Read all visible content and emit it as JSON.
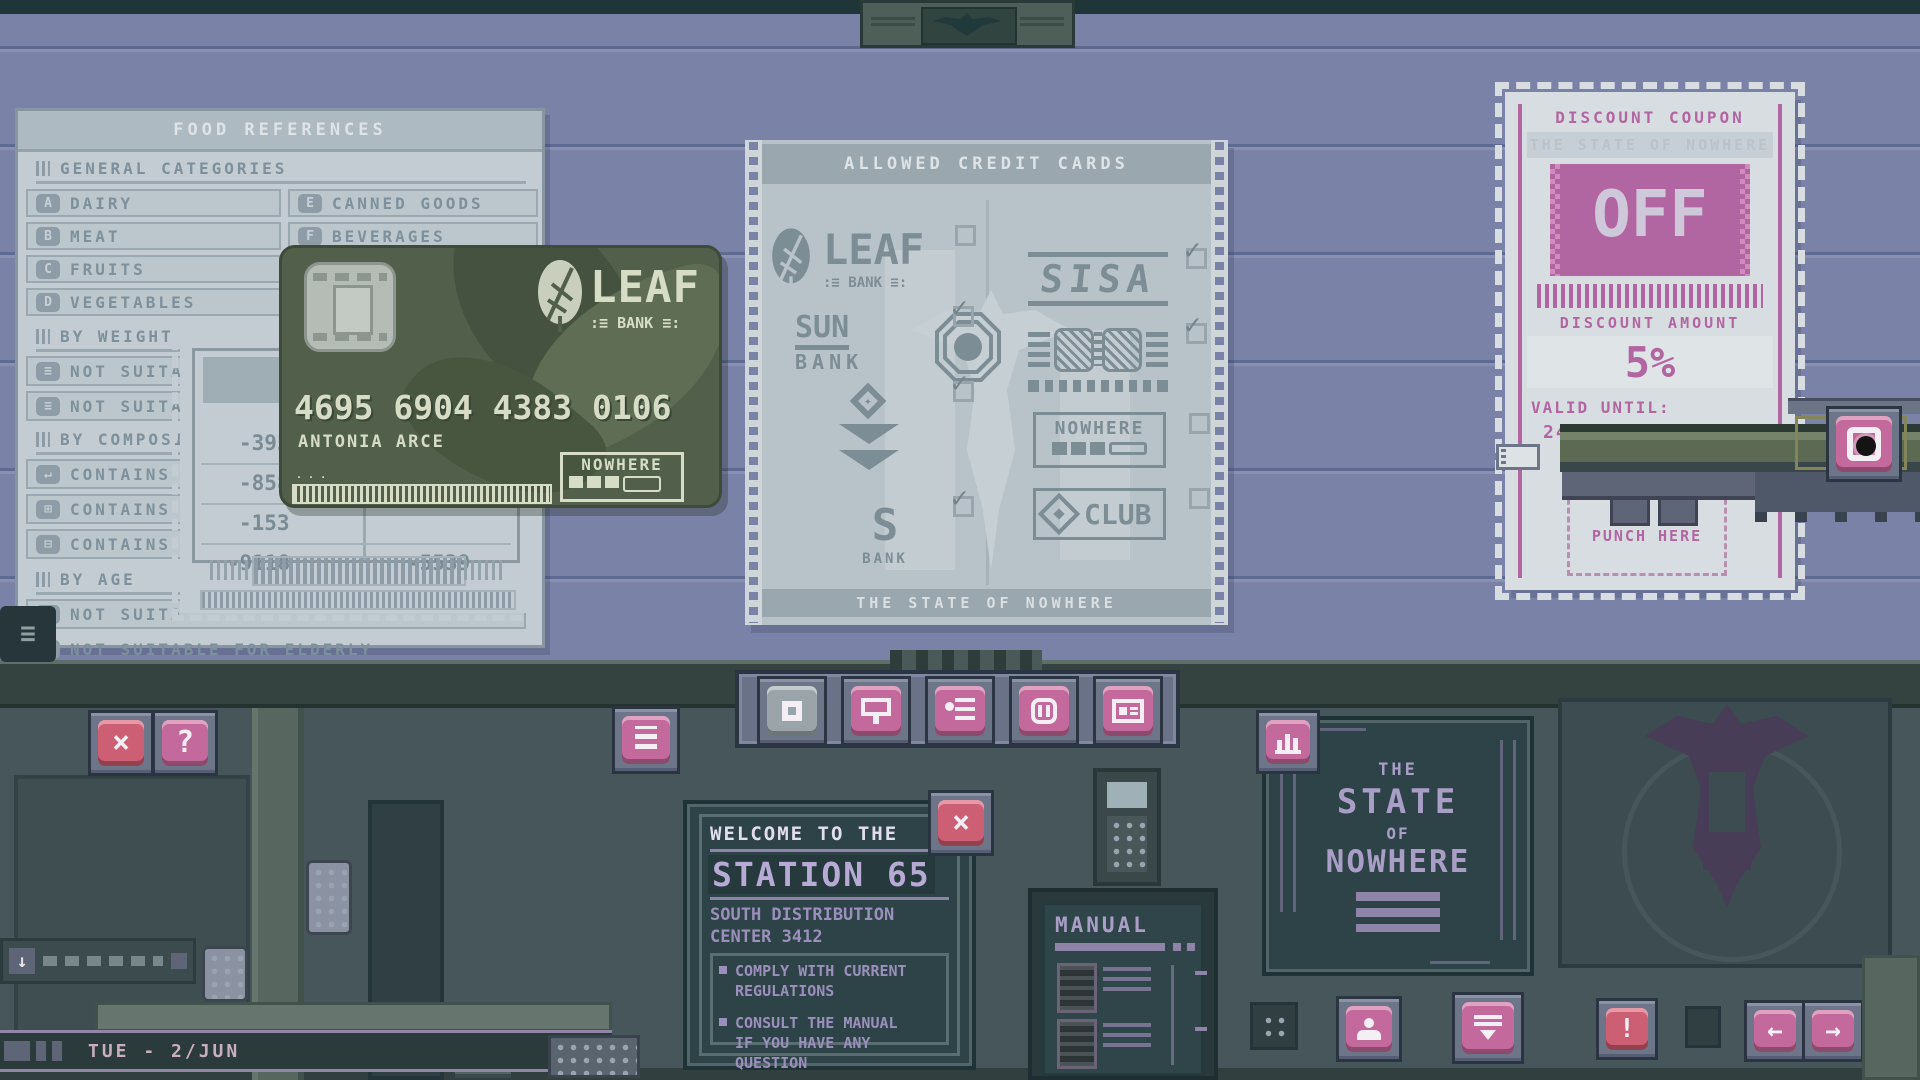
{
  "colors": {
    "wall": "#7a83a7",
    "console": "#47565a",
    "paper": "#c2ccd2",
    "poster_paper": "#b8c3c9",
    "card_green": "#515f4b",
    "coupon_pink": "#b266a1",
    "button_pink": "#c4699b",
    "button_red": "#cd5f74",
    "board_teal": "#2e4347",
    "text_lavender": "#a99fc6"
  },
  "food_references": {
    "title": "FOOD REFERENCES",
    "general": {
      "header": "GENERAL CATEGORIES",
      "left": [
        {
          "key": "A",
          "label": "DAIRY"
        },
        {
          "key": "B",
          "label": "MEAT"
        },
        {
          "key": "C",
          "label": "FRUITS"
        },
        {
          "key": "D",
          "label": "VEGETABLES"
        }
      ],
      "right": [
        {
          "key": "E",
          "label": "CANNED GOODS"
        },
        {
          "key": "F",
          "label": "BEVERAGES"
        }
      ]
    },
    "by_weight": {
      "header": "BY WEIGHT",
      "rows": [
        {
          "label": "NOT SUITA"
        },
        {
          "label": "NOT SUITA"
        }
      ]
    },
    "by_composition": {
      "header": "BY COMPOSI",
      "rows": [
        {
          "label": "CONTAINS"
        },
        {
          "label": "CONTAINS"
        },
        {
          "label": "CONTAINS"
        }
      ]
    },
    "by_age": {
      "header": "BY AGE",
      "rows": [
        {
          "label": "NOT SUITA"
        },
        {
          "label": "NOT SUITABLE FOR ELDERLY"
        }
      ]
    }
  },
  "receipt": {
    "header_line1": "UV",
    "header_line2": "UND",
    "rows": [
      {
        "left": "-395",
        "right": ""
      },
      {
        "left": "-858",
        "right": ""
      },
      {
        "left": "-153",
        "right": ""
      },
      {
        "left": "-9118",
        "right": "-5539"
      }
    ]
  },
  "credit_card": {
    "bank": "LEAF",
    "bank_sub": ":≡ BANK ≡:",
    "number": "4695 6904 4383 0106",
    "holder": "ANTONIA ARCE",
    "badge": "NOWHERE"
  },
  "poster": {
    "title": "ALLOWED CREDIT CARDS",
    "footer": "THE STATE OF NOWHERE",
    "leaf": {
      "name": "LEAF",
      "sub": ":≡ BANK ≡:",
      "mark": ""
    },
    "sun": {
      "name": "SUN",
      "sub": "BANK",
      "mark": "✓"
    },
    "diamond": {
      "mark": "✓"
    },
    "sbank": {
      "name": "S",
      "sub": "BANK",
      "mark": "✓"
    },
    "sisa": {
      "name": "SISA",
      "mark": "✓"
    },
    "goggles": {
      "mark": "✓"
    },
    "nowhere": {
      "name": "NOWHERE",
      "mark": ""
    },
    "club": {
      "name": "CLUB",
      "mark": ""
    }
  },
  "coupon": {
    "title": "DISCOUNT COUPON",
    "subtitle": "THE STATE OF NOWHERE",
    "off_text": "OFF",
    "amount_label": "DISCOUNT AMOUNT",
    "amount_value": "5%",
    "valid_label": "VALID UNTIL:",
    "valid_value": "24/DEC",
    "punch_label": "PUNCH HERE"
  },
  "welcome_board": {
    "intro": "WELCOME TO THE",
    "station": "STATION 65",
    "sub_line1": "SOUTH DISTRIBUTION",
    "sub_line2": "CENTER 3412",
    "bullet1_line1": "COMPLY WITH CURRENT",
    "bullet1_line2": "REGULATIONS",
    "bullet2_line1": "CONSULT THE MANUAL",
    "bullet2_line2": "IF YOU HAVE ANY",
    "bullet2_line3": "QUESTION"
  },
  "plaque": {
    "line1": "THE",
    "line2": "STATE",
    "line3": "OF",
    "line4": "NOWHERE"
  },
  "manual_panel": {
    "title": "MANUAL"
  },
  "status": {
    "date": "TUE - 2/JUN"
  },
  "locker": {
    "number": "65"
  },
  "buttons": {
    "close_x": "×",
    "help": "?",
    "alert": "!",
    "prev": "←",
    "next": "→"
  }
}
